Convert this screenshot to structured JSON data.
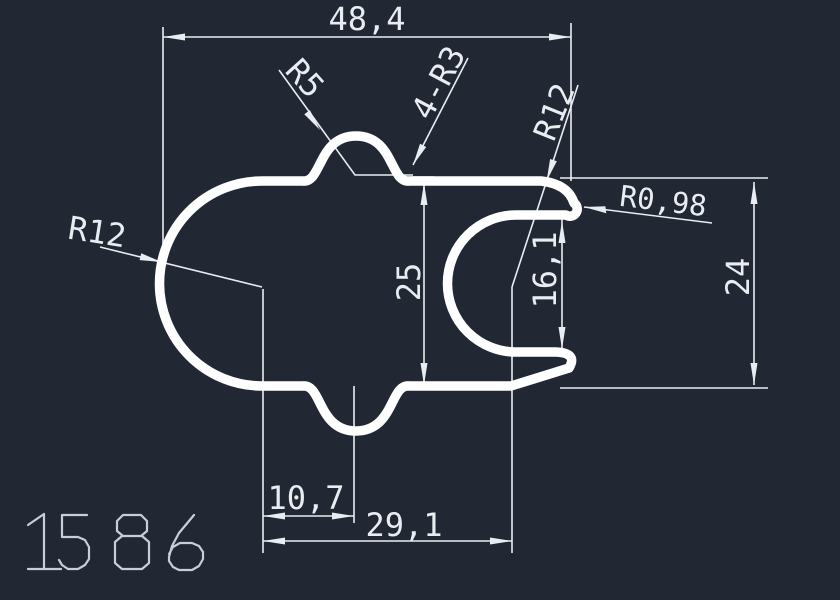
{
  "drawing": {
    "part_number": "1586",
    "colors": {
      "background": "#212833",
      "profile_line": "#ffffff",
      "dim_line": "#e9edf2",
      "part_number_stroke": "#c9ced6"
    },
    "labels": {
      "width_top": "48,4",
      "radius_bump": "R5",
      "fillets": "4-R3",
      "radius_channel": "R12",
      "radius_lip_tip": "R0,98",
      "height_body": "25",
      "height_opening": "16,1",
      "height_overall": "24",
      "offset_bump_center": "10,7",
      "distance_centers": "29,1",
      "radius_body": "R12"
    }
  }
}
